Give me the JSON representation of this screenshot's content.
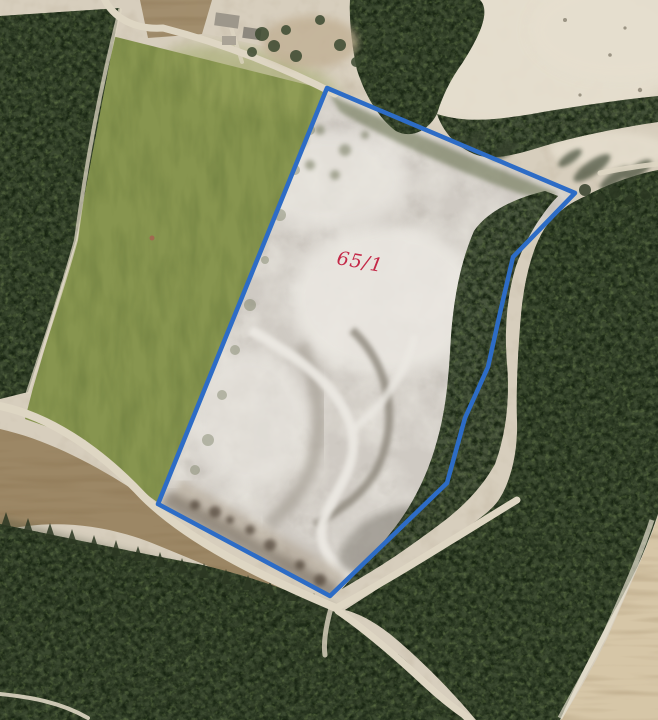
{
  "annotation": {
    "parcel_label": "65/1",
    "label_color": "#c42847",
    "outline_color": "#2d6cc6"
  },
  "palette": {
    "sand": "#d7cebd",
    "sand_bright": "#e6dfcf",
    "quarry_floor": "#cfcac3",
    "quarry_white": "#ebe8e2",
    "meadow": "#87954f",
    "meadow_light": "#98a35c",
    "field_green": "#74904a",
    "field_tan": "#d6c6a7",
    "plow_brown": "#9c8765",
    "forest": "#3b4930",
    "forest_dark": "#2b3722",
    "scrub": "#6e7757",
    "road": "#ded6c3",
    "track_brown": "#9a7b52",
    "shadow": "#39422f",
    "building": "#9d978b",
    "building_dark": "#8d887e",
    "rubble": "#54493c"
  }
}
